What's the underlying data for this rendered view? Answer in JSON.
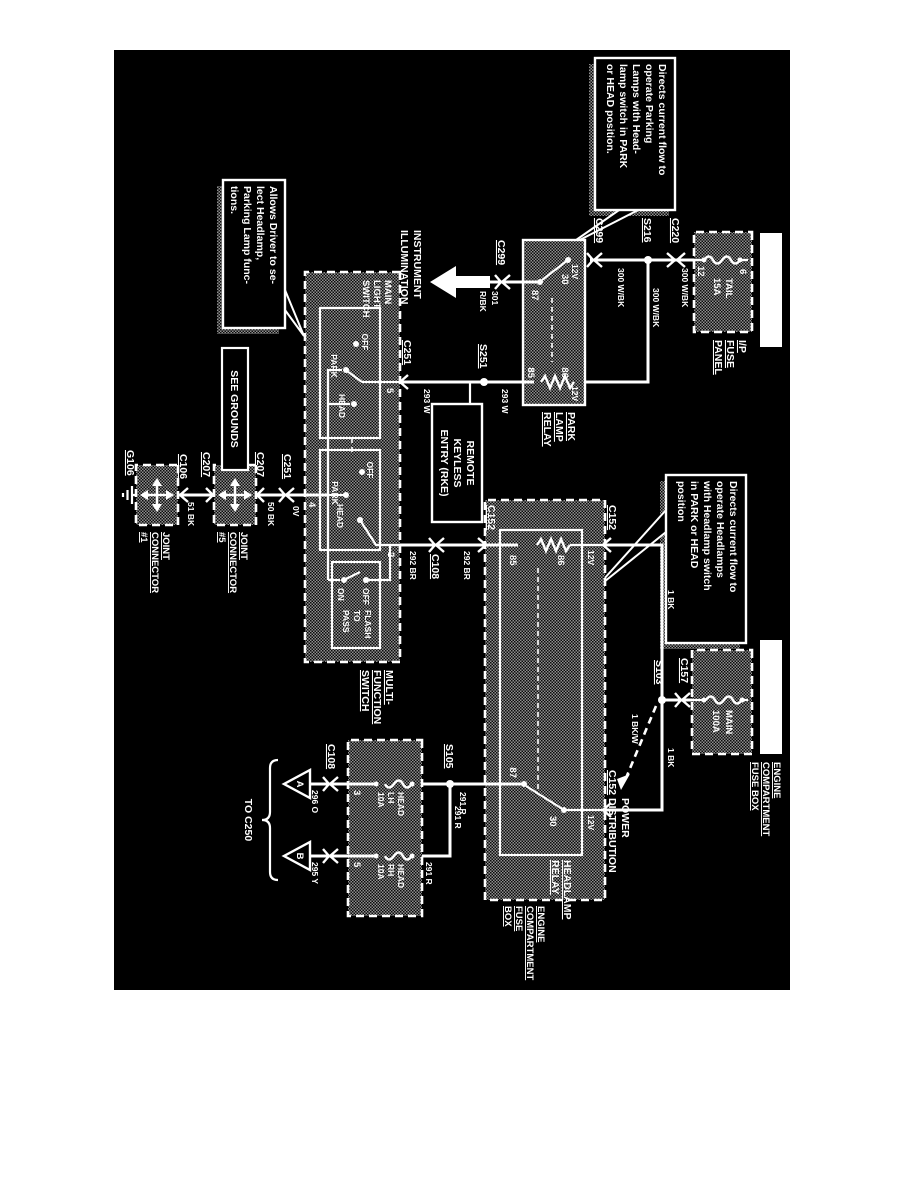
{
  "hot_label": "HOT AT ALL TIMES",
  "callout_park": {
    "lines": [
      "Directs current flow to",
      "operate    Parking",
      "Lamps with Head-",
      "lamp switch in PARK",
      "or HEAD position."
    ]
  },
  "callout_head": {
    "lines": [
      "Directs current flow to",
      "operate  Headlamps",
      "with Headlamp switch",
      "in  PARK  or  HEAD",
      "position"
    ]
  },
  "callout_driver": {
    "lines": [
      "Allows Driver to se-",
      "lect    Headlamp,",
      "Parking Lamp func-",
      "tions."
    ]
  },
  "ip_panel": {
    "name_lines": [
      "I/P",
      "FUSE",
      "PANEL"
    ],
    "fuse_name": "TAIL",
    "fuse_rating": "15A",
    "pin_top": "6",
    "pin_bottom": "12"
  },
  "conn": {
    "c220": "C220",
    "s216": "S216",
    "c299": "C299",
    "s251": "S251",
    "c251": "C251",
    "c207": "C207",
    "c106": "C106",
    "g106": "G106",
    "c108": "C108",
    "c152": "C152",
    "c157": "C157",
    "s103": "S103",
    "s105": "S105"
  },
  "wire": {
    "w300": "300 W/BK",
    "w301n": "301",
    "w301c": "R/BK",
    "w293": "293 W",
    "w292": "292 BR",
    "w291": "291 R",
    "w296": "296 O",
    "w295": "295 Y",
    "w50": "50 BK",
    "w51": "51 BK",
    "w1": "1 BK",
    "w1bw": "1 BK/W",
    "v12": "12V",
    "v0": "0V"
  },
  "park_relay": {
    "lines": [
      "PARK",
      "LAMP",
      "RELAY"
    ],
    "p30": "30",
    "p87": "87",
    "p86": "86",
    "p85": "85"
  },
  "inst": {
    "lines": [
      "INSTRUMENT",
      "ILLUMINATION"
    ]
  },
  "rke": {
    "lines": [
      "REMOTE",
      "KEYLESS",
      "ENTRY (RKE)"
    ]
  },
  "mfs": {
    "label_lines": [
      "MULTI-",
      "FUNCTION",
      "SWITCH"
    ],
    "mls_lines": [
      "MAIN",
      "LIGHT",
      "SWITCH"
    ],
    "off": "OFF",
    "park": "PARK",
    "head": "HEAD",
    "on": "ON",
    "ftp_lines": [
      "FLASH",
      "TO",
      "PASS"
    ],
    "p5": "5",
    "p4": "4",
    "p2": "2"
  },
  "grounds": {
    "see": "SEE GROUNDS",
    "jc5_lines": [
      "JOINT",
      "CONNECTOR",
      "#5"
    ],
    "jc1_lines": [
      "JOINT",
      "CONNECTOR",
      "#1"
    ]
  },
  "ecfb": {
    "lines3": [
      "ENGINE",
      "COMPARTMENT",
      "FUSE BOX"
    ],
    "lines4": [
      "ENGINE",
      "COMPARTMENT",
      "FUSE",
      "BOX"
    ],
    "main_fuse": "MAIN",
    "main_rating": "100A"
  },
  "hl_relay": {
    "lines": [
      "HEADLAMP",
      "RELAY"
    ],
    "p30": "30",
    "p87": "87",
    "p86": "86",
    "p85": "85"
  },
  "power_dist": {
    "lines": [
      "POWER",
      "DISTRIBUTION"
    ]
  },
  "head_fuses": {
    "lh_lines": [
      "HEAD",
      "LH",
      "10A"
    ],
    "rh_lines": [
      "HEAD",
      "RH",
      "10A"
    ],
    "pin3": "3",
    "pin5": "5"
  },
  "dest": {
    "a": "A",
    "b": "B",
    "to": "TO C250"
  }
}
